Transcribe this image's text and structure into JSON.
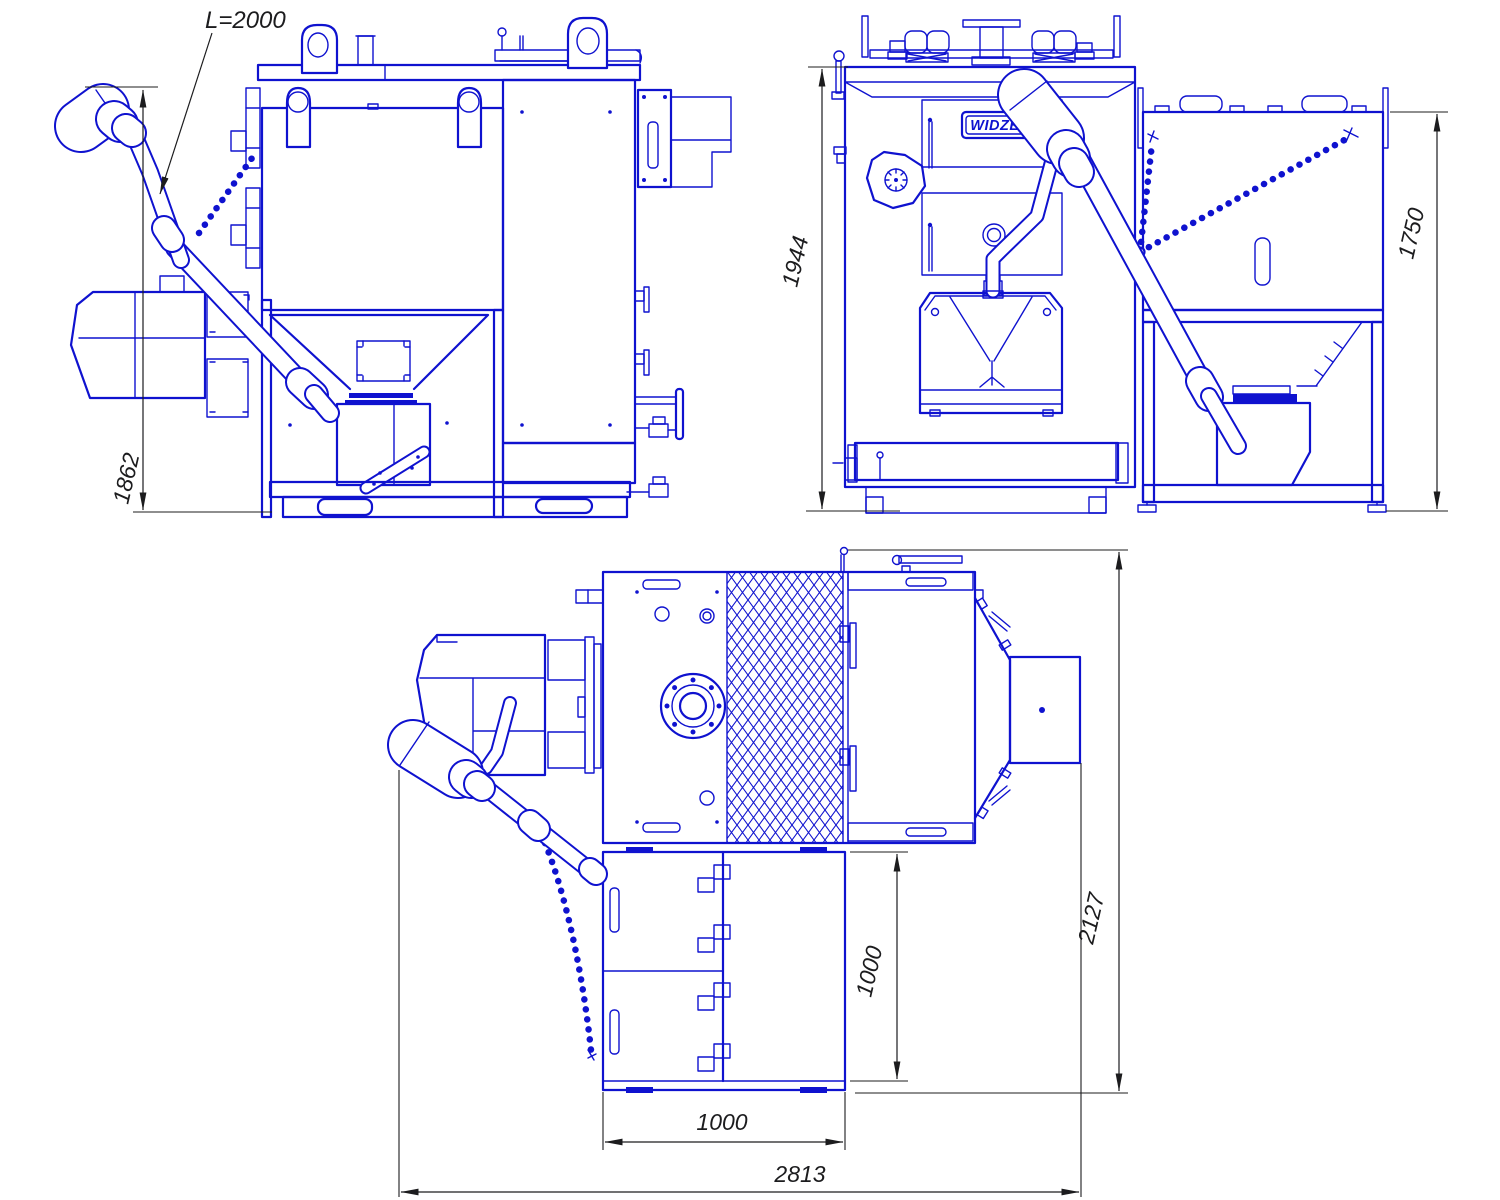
{
  "meta": {
    "title": "Pellet boiler with fuel hopper and auger feeder — three-view technical drawing",
    "drawing_color": "#0f12cf",
    "dimension_color": "#1c1c1e",
    "background": "#ffffff"
  },
  "views": {
    "side": {
      "label": "side-view",
      "dims": {
        "overall_height": "1862",
        "auger_length": "L=2000"
      }
    },
    "front": {
      "label": "front-view",
      "brand_badge": "WIDZEW",
      "dims": {
        "boiler_height": "1944",
        "hopper_height": "1750"
      }
    },
    "top": {
      "label": "top-view",
      "dims": {
        "overall_length": "2813",
        "overall_depth": "2127",
        "hopper_width": "1000",
        "hopper_depth": "1000"
      }
    }
  }
}
